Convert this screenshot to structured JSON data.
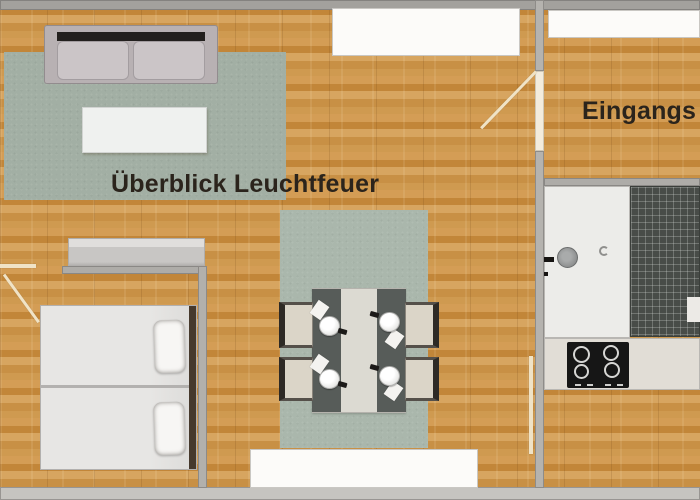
{
  "floorplan": {
    "labels": {
      "living_overview": "Überblick Leuchtfeuer",
      "entrance": "Eingangs"
    },
    "colors": {
      "wood_floor": "#cb9248",
      "wall_dark": "#a3a19d",
      "wall_light": "#c6c4c0",
      "rug_green": "#a6b3a8",
      "sofa_frame": "#b8b1b3",
      "dark_accent": "#23201e",
      "counter_dark": "#484c48",
      "fixture_white": "#fcfbf9",
      "door_line": "#f0e3c6",
      "label_text": "#2b241c"
    },
    "elements": {
      "living_area": [
        "sofa",
        "coffee-table",
        "area-rug",
        "sideboard"
      ],
      "sleeping_area": [
        "twin-bed-upper",
        "twin-bed-lower",
        "pillows",
        "headboard"
      ],
      "dining_area": [
        "area-rug",
        "dining-table",
        "chairs-4",
        "place-settings-4"
      ],
      "kitchen": [
        "sink",
        "faucet",
        "dark-countertop",
        "cooktop-4-burners",
        "lower-counter"
      ],
      "openings": [
        "door-living-entrance",
        "door-sleeping-area",
        "door-kitchen",
        "window-top",
        "window-entrance",
        "window-bottom"
      ]
    }
  }
}
